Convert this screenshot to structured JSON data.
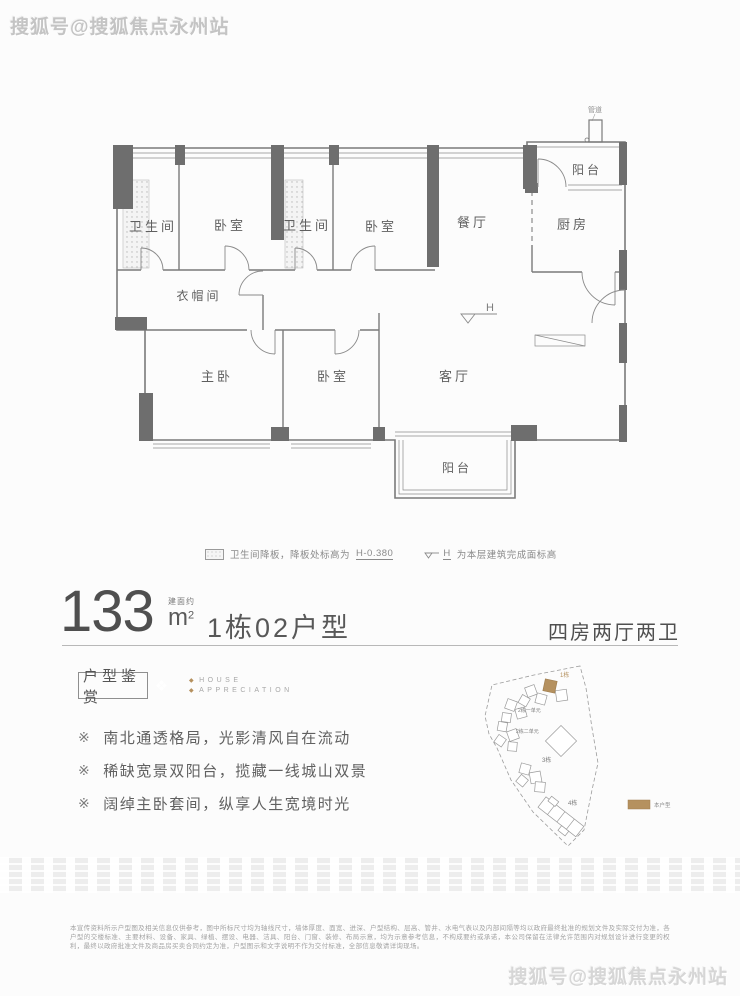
{
  "watermarks": {
    "top_left": "搜狐号@搜狐焦点永州站",
    "bottom_right": "搜狐号@搜狐焦点永州站"
  },
  "accent_color": "#b5915f",
  "floorplan": {
    "rooms": [
      "卫生间",
      "卧室",
      "卫生间",
      "卧室",
      "餐厅",
      "厨房",
      "阳台",
      "衣帽间",
      "主卧",
      "卧室",
      "客厅",
      "阳台"
    ],
    "duct_label": "管道",
    "level_symbol": "H",
    "notes": {
      "drop_note": "卫生间降板，降板处标高为",
      "drop_value": "H-0.380",
      "level_prefix": "H",
      "level_note": "为本层建筑完成面标高"
    }
  },
  "title": {
    "area": "133",
    "area_approx": "建面约",
    "unit": "m",
    "sup": "2",
    "name": "1栋02户型",
    "layout": "四房两厅两卫"
  },
  "appreciation": {
    "badge": "户型鉴赏",
    "ornament": "❖",
    "en_line1": "HOUSE",
    "en_line2": "APPRECIATION",
    "bullets": [
      {
        "marker": "※",
        "text": "南北通透格局，光影清风自在流动"
      },
      {
        "marker": "※",
        "text": "稀缺宽景双阳台，揽藏一线城山双景"
      },
      {
        "marker": "※",
        "text": "阔绰主卧套间，纵享人生宽境时光"
      }
    ]
  },
  "siteplan": {
    "building_labels": [
      "1栋",
      "2栋一单元",
      "2栋二单元",
      "3栋",
      "4栋"
    ],
    "legend_label": "本户型"
  },
  "disclaimer": {
    "line1": "本宣传资料所示户型图及相关信息仅供参考，图中所标尺寸均为轴线尺寸，墙体厚度、面宽、进深、户型结构、层高、管井、水电气表以及内部间隔等均以政府最终批准的规划文件及实际交付为准，各户型的交楼标准、主要材料、设备、家具、绿植、摆设、电",
    "line2": "器、洁具、阳台、门窗、装修、布局示意，均为示意参考信息，不构成要约或承诺，本公司保留在法律允许范围内对规划设计进行变更的权利，最终以政府批准文件及商品房买卖合同约定为准，户型图示和文字说明不作为交付标准，全部信息敬请详询现场。"
  }
}
